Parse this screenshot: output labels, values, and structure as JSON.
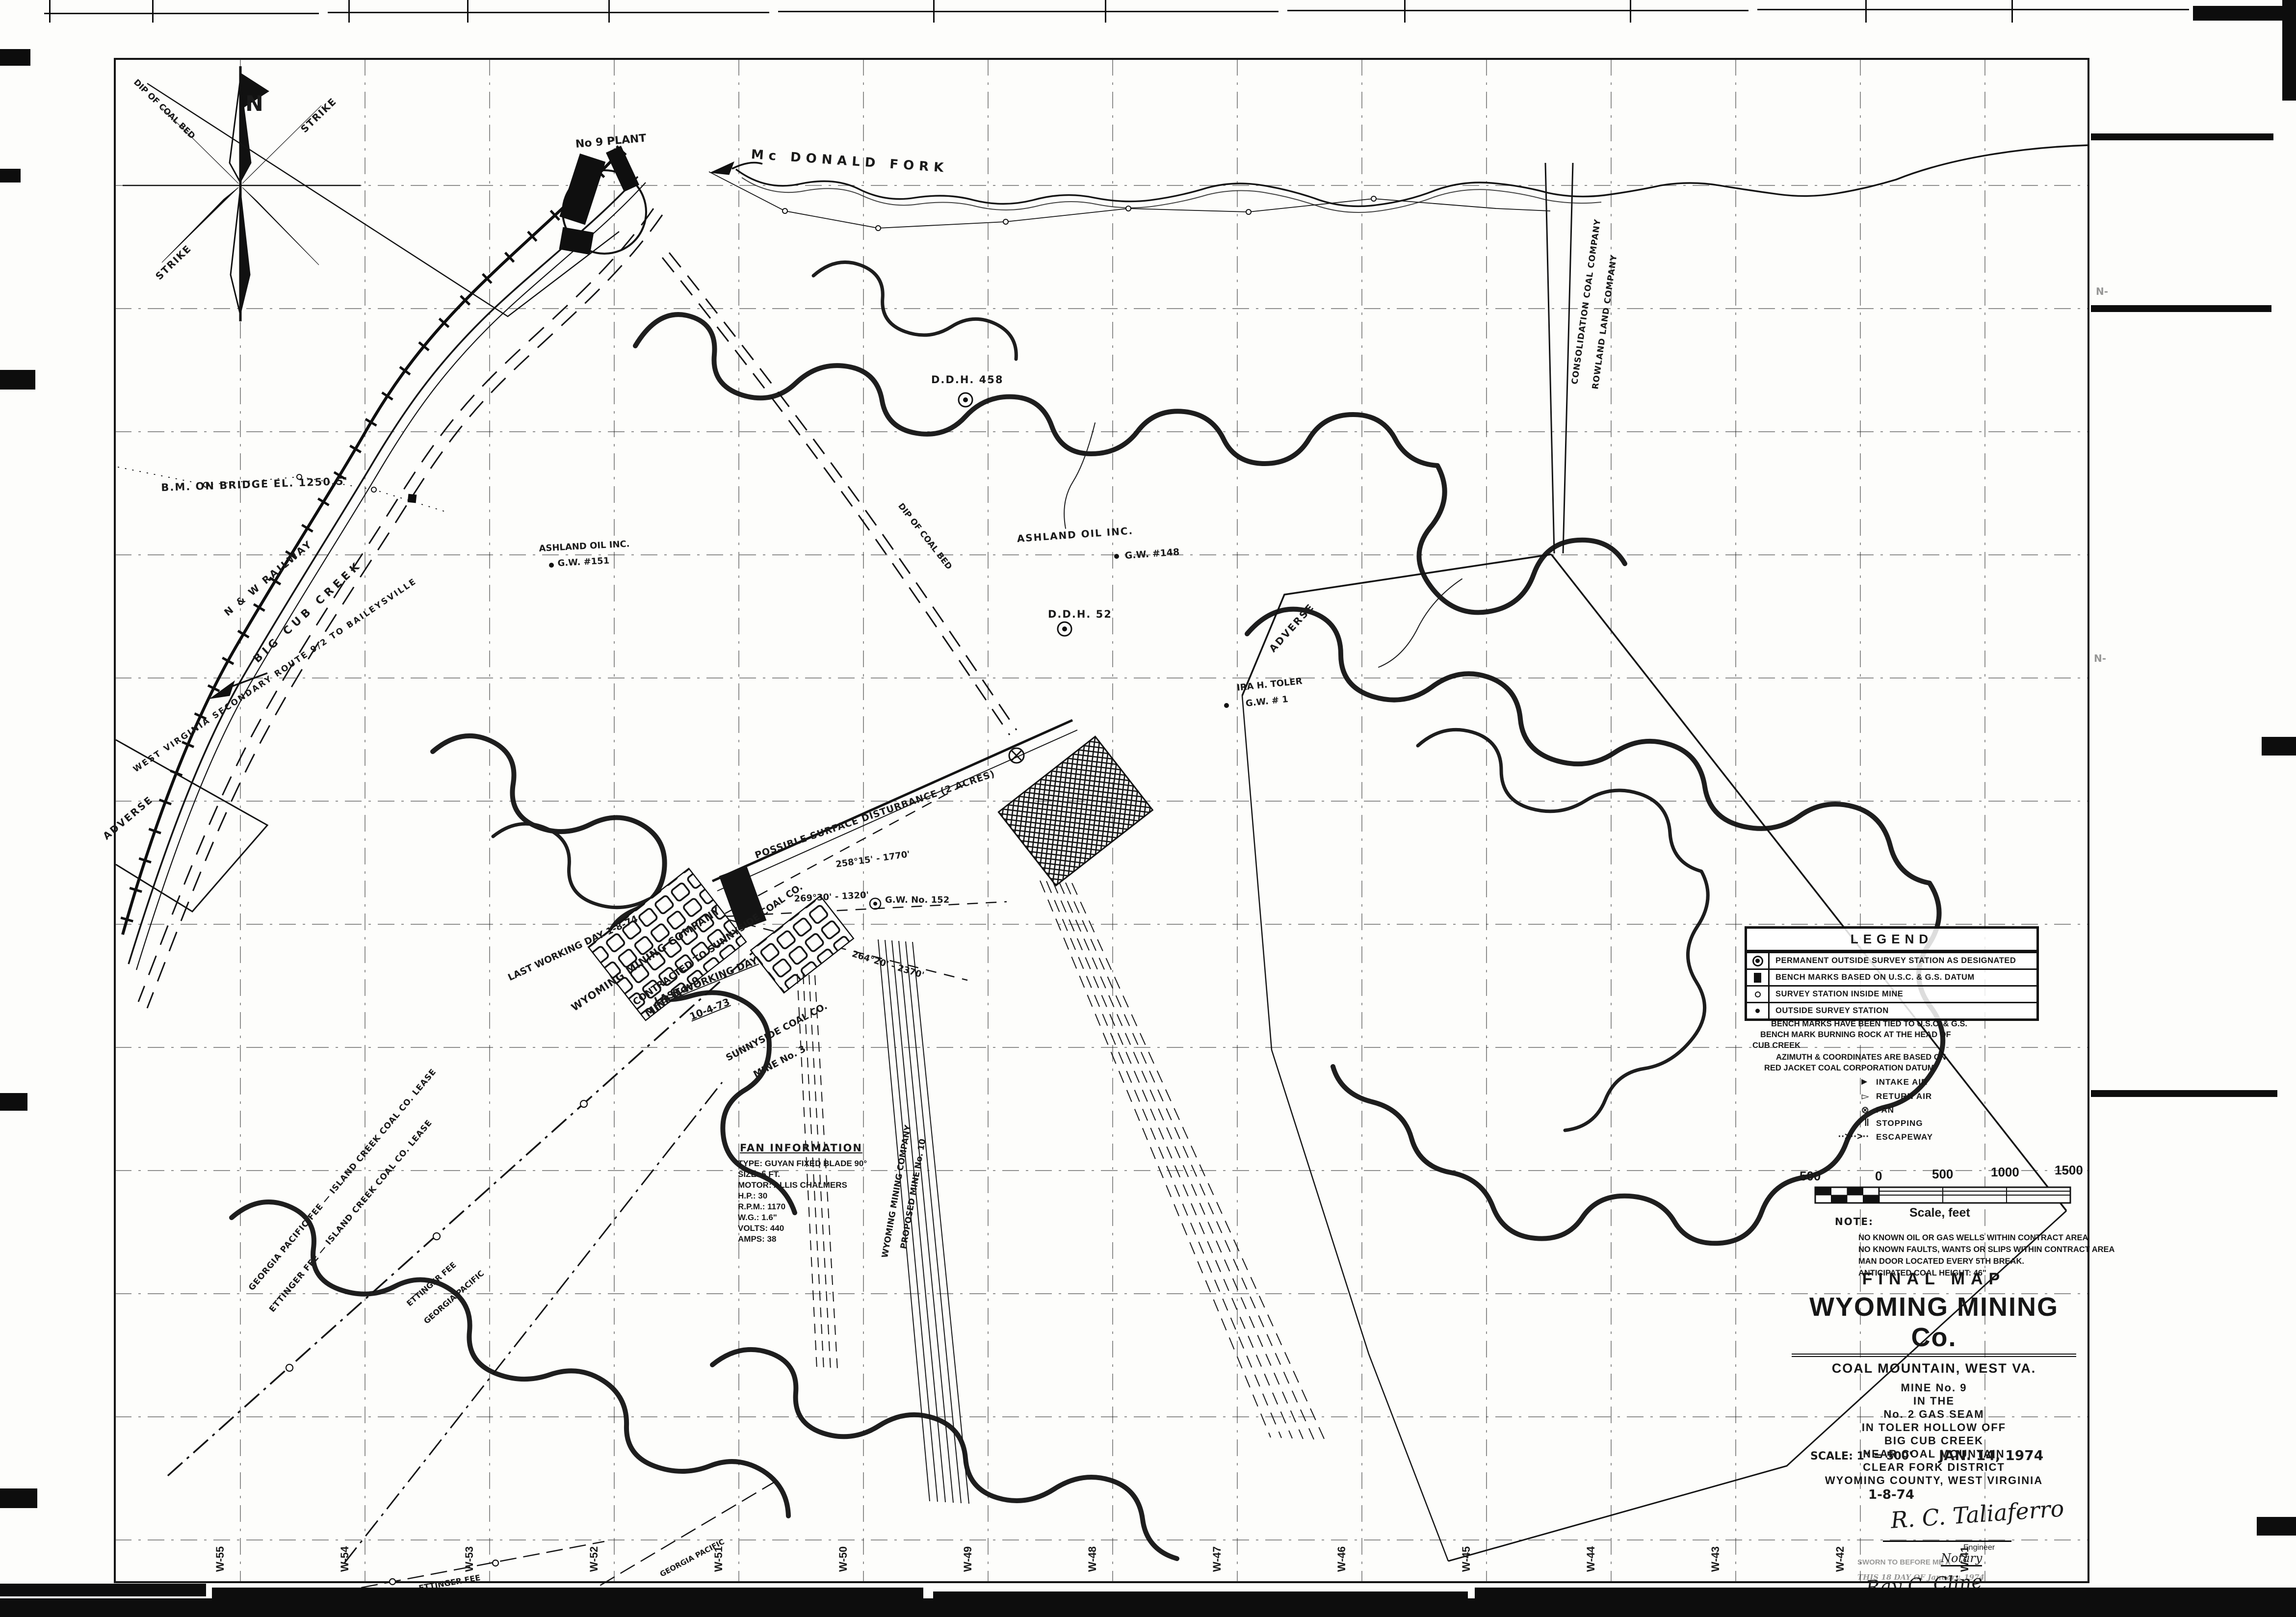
{
  "compass": {
    "north": "N",
    "strike": "STRIKE",
    "dip_label": "DIP OF COAL BED"
  },
  "labels": {
    "no9_plant": "No 9 PLANT",
    "mcdonald_fork": "Mc DONALD FORK",
    "bm_bridge": "B.M. ON BRIDGE EL. 1250.5'",
    "nw_railway": "N & W RAILWAY",
    "big_cub_creek": "BIG CUB CREEK",
    "wv_route": "WEST VIRGINIA SECONDARY ROUTE 9/2 TO BAILEYSVILLE",
    "adverse": "ADVERSE",
    "dip_coal_bed": "DIP OF COAL BED",
    "ashland_oil": "ASHLAND OIL INC.",
    "gw148": "G.W. #148",
    "gw151": "G.W. #151",
    "gw152": "G.W. No. 152",
    "gw1": "G.W. # 1",
    "ira_toler": "IRA H. TOLER",
    "ddh458": "D.D.H. 458",
    "ddh52": "D.D.H. 52",
    "possible_surface": "POSSIBLE SURFACE DISTURBANCE (2 ACRES)",
    "bearing_1": "258°15' - 1770'",
    "bearing_2": "269°30' - 1320'",
    "bearing_3": "264°20' - 2370'",
    "wyoming_mining_company": "WYOMING MINING COMPANY",
    "mine_no_9": "MINE No. 9",
    "contracted": "CONTRACTED TO SUNNYSIDE COAL CO.",
    "last_working_day": "LAST WORKING DAY",
    "date_10_4_73": "10-4-73",
    "last_working_west": "LAST WORKING DAY 1-8-74",
    "sunnyside": "SUNNYSIDE COAL CO.",
    "mine_no_3": "MINE No. 3",
    "ettinger_island": "ETTINGER FEE — ISLAND CREEK COAL CO. LEASE",
    "georgia_island": "GEORGIA PACIFIC FEE — ISLAND CREEK COAL CO. LEASE",
    "ettinger_fee": "ETTINGER FEE",
    "georgia_pacific": "GEORGIA PACIFIC",
    "consolidation": "CONSOLIDATION COAL COMPANY",
    "rowland": "ROWLAND LAND COMPANY",
    "proposed_10": "PROPOSED MINE No. 10",
    "n_margin": "N-"
  },
  "legend": {
    "title": "LEGEND",
    "items": [
      {
        "symbol": "circled-dot",
        "label": "PERMANENT OUTSIDE SURVEY STATION AS DESIGNATED"
      },
      {
        "symbol": "solid-square",
        "label": "BENCH MARKS BASED ON U.S.C. & G.S. DATUM"
      },
      {
        "symbol": "small-circle",
        "label": "SURVEY STATION INSIDE MINE"
      },
      {
        "symbol": "small-dot",
        "label": "OUTSIDE SURVEY STATION"
      }
    ],
    "notes": [
      "BENCH MARKS HAVE BEEN TIED TO U.S.C. & G.S.",
      "BENCH MARK BURNING ROCK AT THE HEAD OF",
      "CUB CREEK",
      "AZIMUTH & COORDINATES ARE BASED ON",
      "RED JACKET COAL CORPORATION DATUM"
    ],
    "air": [
      {
        "glyph": "►",
        "label": "INTAKE AIR"
      },
      {
        "glyph": "▻",
        "label": "RETURN AIR"
      },
      {
        "glyph": "⊗",
        "label": "FAN"
      },
      {
        "glyph": "‖",
        "label": "STOPPING"
      },
      {
        "glyph": "··>··>··",
        "label": "ESCAPEWAY"
      }
    ]
  },
  "scale_bar": {
    "ticks": [
      "500",
      "0",
      "500",
      "1000",
      "1500"
    ],
    "caption": "Scale, feet"
  },
  "note_block": {
    "title": "NOTE:",
    "lines": [
      "NO KNOWN OIL OR GAS WELLS WITHIN CONTRACT AREA",
      "NO KNOWN FAULTS, WANTS OR SLIPS WITHIN CONTRACT AREA",
      "MAN DOOR LOCATED EVERY 5TH BREAK.",
      "ANTICIPATED COAL HEIGHT: 46\""
    ]
  },
  "fan_info": {
    "title": "FAN INFORMATION",
    "lines": [
      "TYPE: GUYAN FIXED BLADE 90°",
      "SIZE: 5 FT.",
      "MOTOR: ALLIS CHALMERS",
      "H.P.: 30",
      "R.P.M.: 1170",
      "W.G.: 1.6\"",
      "VOLTS: 440",
      "AMPS: 38"
    ]
  },
  "title_block": {
    "final_map": "FINAL MAP",
    "company": "WYOMING MINING Co.",
    "location": "COAL MOUNTAIN, WEST VA.",
    "lines": [
      "MINE No. 9",
      "IN THE",
      "No. 2 GAS SEAM",
      "IN TOLER HOLLOW OFF",
      "BIG CUB CREEK",
      "NEAR COAL MOUNTAIN",
      "CLEAR FORK DISTRICT",
      "WYOMING COUNTY, WEST VIRGINIA"
    ],
    "scale": "SCALE: 1\" = 500'",
    "date": "JAN. 14, 1974"
  },
  "signature_block": {
    "date": "1-8-74",
    "engineer_signature": "R. C. Taliaferro",
    "engineer_title": "Engineer",
    "sworn_line": "SWORN TO BEFORE ME A",
    "notary_word": "Notary",
    "date_line": "THIS 18 DAY OF January, 1974",
    "notary_signature": "Ray C. Cline"
  },
  "grid": {
    "bottom_labels": [
      "W-55",
      "W-54",
      "W-53",
      "W-52",
      "W-51",
      "W-50",
      "W-49",
      "W-48",
      "W-47",
      "W-46",
      "W-45",
      "W-44",
      "W-43",
      "W-42",
      "W-41"
    ]
  }
}
